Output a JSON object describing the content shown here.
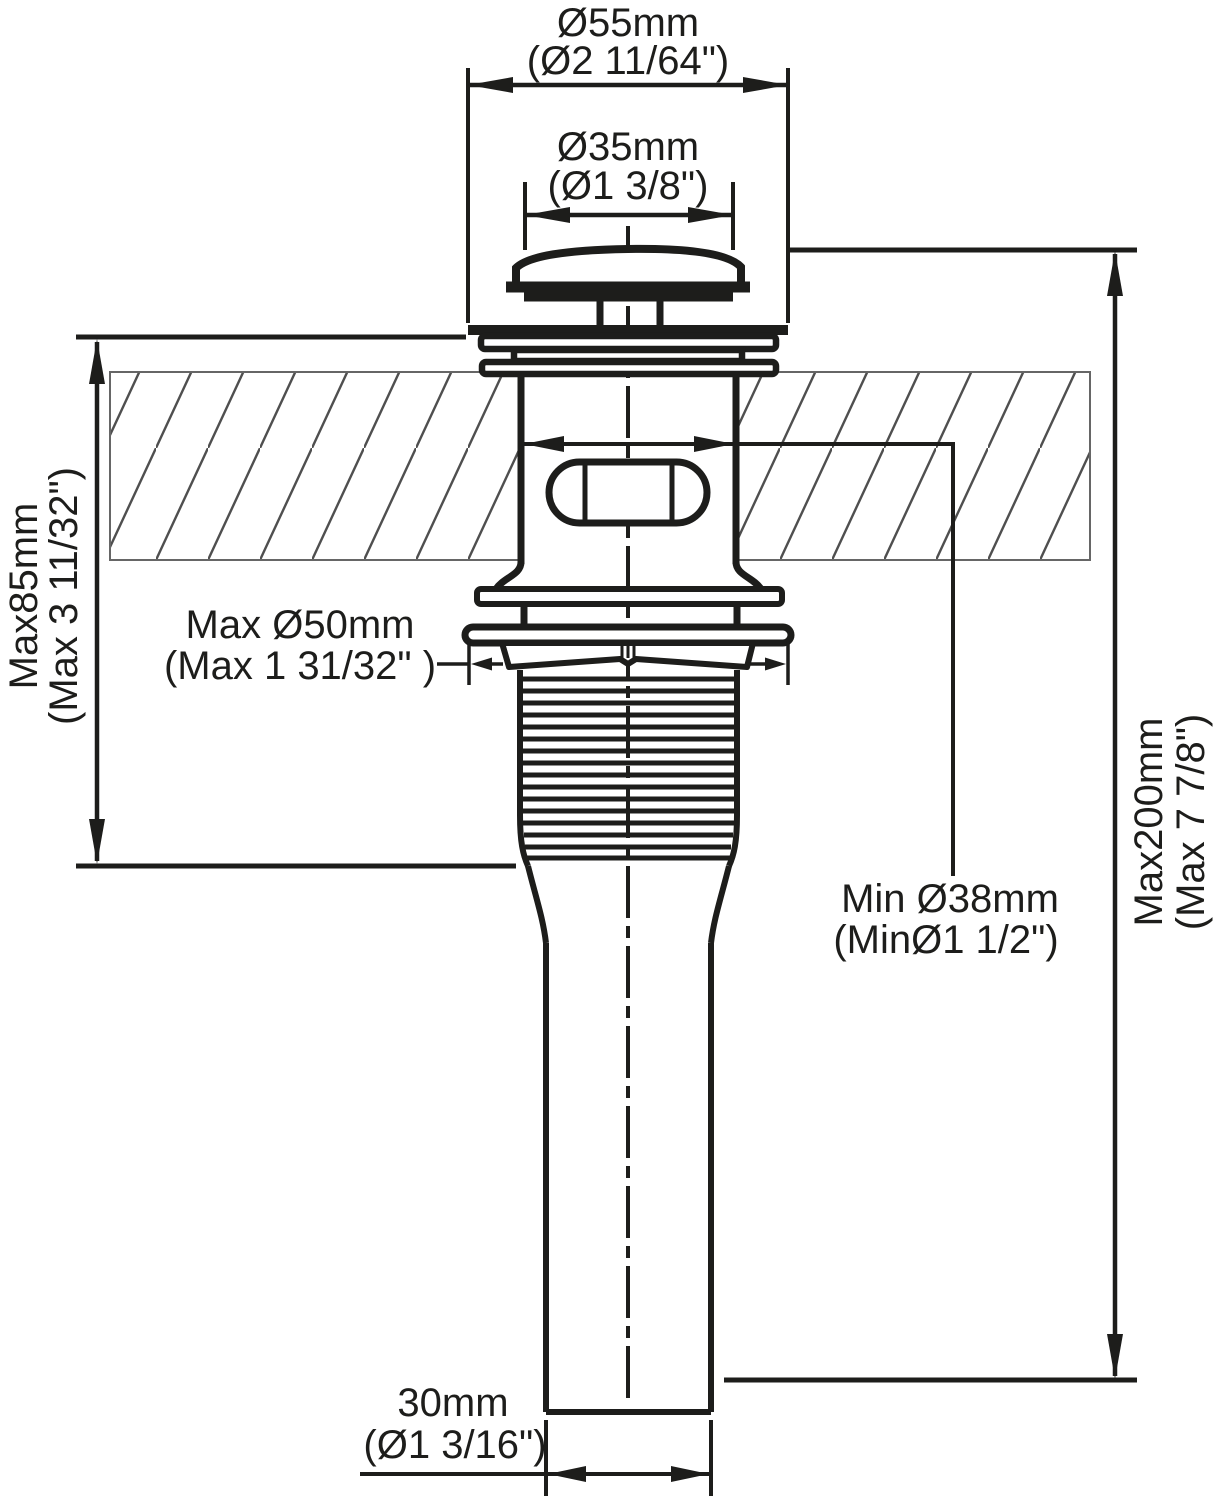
{
  "diagram": {
    "kind": "pop-up sink drain installation dimension drawing",
    "colors": {
      "line": "#1d1d1b",
      "hatch": "#4f4f4f",
      "background": "#ffffff"
    }
  },
  "dims": {
    "cap_od": {
      "mm": "Ø55mm",
      "inch": "(Ø2 11/64\")"
    },
    "cap_top": {
      "mm": "Ø35mm",
      "inch": "(Ø1 3/8\")"
    },
    "mount_depth": {
      "mm": "Max85mm",
      "inch": "(Max 3 11/32\")"
    },
    "hole_max": {
      "mm": "Max Ø50mm",
      "inch": "(Max 1 31/32\" )"
    },
    "hole_min": {
      "mm": "Min Ø38mm",
      "inch": "(MinØ1 1/2\")"
    },
    "total_length": {
      "mm": "Max200mm",
      "inch": "(Max 7 7/8\")"
    },
    "tail_od": {
      "mm": "30mm",
      "inch": "(Ø1 3/16\")"
    }
  }
}
